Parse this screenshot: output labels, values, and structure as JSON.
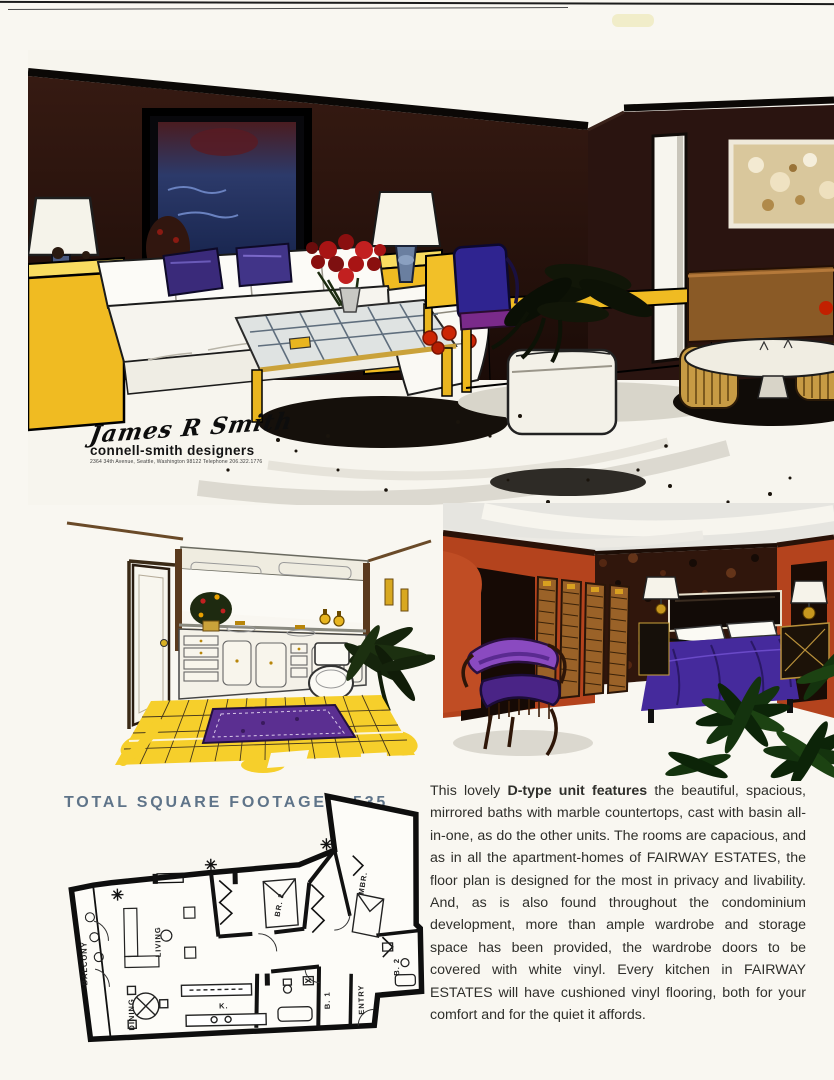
{
  "page": {
    "type": "scanned brochure page",
    "bg": "#f9f7f1"
  },
  "heading": {
    "text": "TOTAL SQUARE FOOTAGE 1,535",
    "color": "#5f7489"
  },
  "signature": {
    "name": "James R Smith",
    "firm": "connell-smith designers",
    "address": "2364 34th Avenue, Seattle, Washington 98122 Telephone 206.322.1776"
  },
  "description": {
    "lead": "This lovely ",
    "bold": "D-type unit features",
    "body": " the beautiful, spacious, mirrored baths with marble countertops, cast with basin all-in-one, as do the other units. The rooms are capacious, and as in all the apartment-homes of FAIRWAY ESTATES, the floor plan is designed for the most in privacy and livability. And, as is also found throughout the condominium development, more than ample wardrobe and storage space has been provided, the wardrobe doors to be covered with white vinyl. Every kitchen in FAIRWAY ESTATES will have cushioned vinyl flooring, both for your comfort and for the quiet it affords."
  },
  "floorplan": {
    "labels": {
      "balcony": "BALCONY",
      "living": "LIVING",
      "dining": "DINING",
      "kitchen": "K.",
      "br2": "BR. 2",
      "mbr": "MBR.",
      "entry": "ENTRY",
      "b1": "B. 1",
      "b2": "B. 2"
    }
  },
  "colors": {
    "wall_brown": "#2a1410",
    "accent_yellow": "#f0bb22",
    "carpet_white": "#f7f5ee",
    "bath_tile": "#f6cf2b",
    "rug_purple": "#5b2f91",
    "bedroom_wall": "#b4431d",
    "bedspread": "#452a9c",
    "pillow_purple": "#3a2a7a"
  }
}
